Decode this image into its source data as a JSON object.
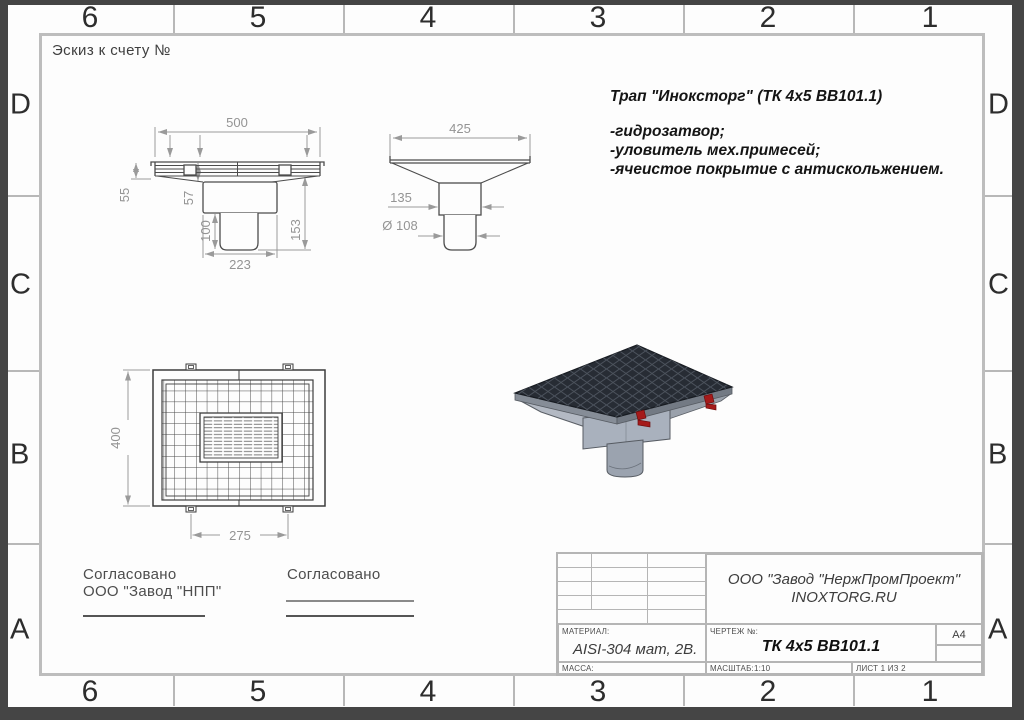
{
  "frame": {
    "sketch_label": "Эскиз к счету №",
    "zones_top": [
      "6",
      "5",
      "4",
      "3",
      "2",
      "1"
    ],
    "zones_bottom": [
      "6",
      "5",
      "4",
      "3",
      "2",
      "1"
    ],
    "rows_left": [
      "D",
      "C",
      "B",
      "A"
    ],
    "rows_right": [
      "D",
      "C",
      "B",
      "A"
    ]
  },
  "description": {
    "title": "Трап \"Иноксторг\" (ТК 4х5 ВВ101.1)",
    "features": [
      "-гидрозатвор;",
      "-уловитель мех.примесей;",
      "-ячеистое покрытие с антискольжением."
    ]
  },
  "dimensions": {
    "front": {
      "width": "500",
      "h_grate": "55",
      "h_flange": "57",
      "h_pipe": "100",
      "h_total": "153",
      "body_width": "223"
    },
    "side": {
      "width": "425",
      "neck": "135",
      "pipe_dia": "Ø 108"
    },
    "plan": {
      "height": "400",
      "clip_span": "275"
    }
  },
  "approvals": {
    "left_line1": "Согласовано",
    "left_line2": "ООО \"Завод \"НПП\"",
    "right_line1": "Согласовано"
  },
  "title_block": {
    "company_line1": "ООО \"Завод \"НержПромПроект\"",
    "company_line2": "INOXTORG.RU",
    "material_label": "МАТЕРИАЛ:",
    "material_value": "AISI-304 мат, 2В.",
    "drawing_label": "ЧЕРТЕЖ №:",
    "drawing_value": "ТК 4х5 ВВ101.1",
    "mass_label": "МАССА:",
    "scale_label": "МАСШТАБ:1:10",
    "sheet_label": "ЛИСТ 1 ИЗ 2",
    "format": "А4"
  },
  "colors": {
    "outer_border": "#454545",
    "frame_line": "#bdbdbd",
    "outline": "#4c4c4c",
    "dimension": "#9a9a9a",
    "accent_red": "#a51a1a",
    "mesh_dark": "#272c34"
  }
}
